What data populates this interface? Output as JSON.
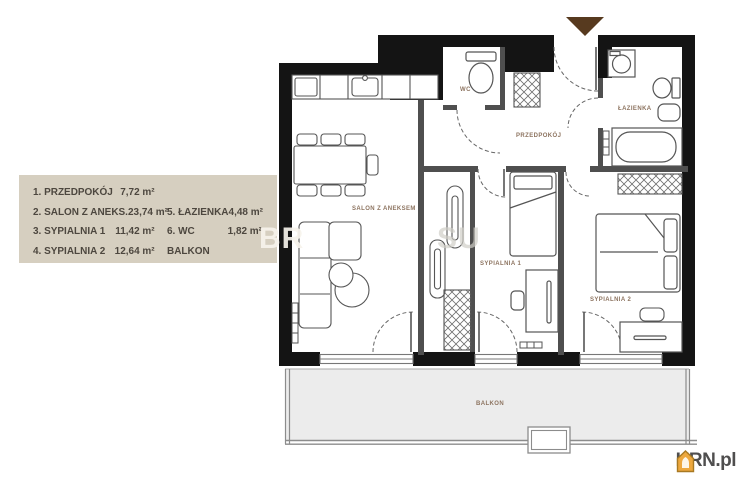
{
  "legend": {
    "background": "#d6cfc0",
    "text_color": "#4d473f",
    "column1": [
      {
        "label": "1. PRZEDPOKÓJ",
        "area": "7,72 m²"
      },
      {
        "label": "2. SALON Z ANEKS.",
        "area": "23,74 m²"
      },
      {
        "label": "3. SYPIALNIA 1",
        "area": "11,42 m²"
      },
      {
        "label": "4. SYPIALNIA 2",
        "area": "12,64 m²"
      }
    ],
    "column2": [
      {
        "label": "5. ŁAZIENKA",
        "area": "4,48 m²"
      },
      {
        "label": "6. WC",
        "area": "1,82 m²"
      },
      {
        "label": "BALKON",
        "area": ""
      }
    ]
  },
  "floorplan": {
    "room_labels": {
      "salon": "SALON Z ANEKSEM",
      "wc": "WC",
      "przedpokoj": "PRZEDPOKÓJ",
      "lazienka": "ŁAZIENKA",
      "sypialnia1": "SYPIALNIA 1",
      "sypialnia2": "SYPIALNIA 2",
      "balkon": "BALKON"
    },
    "label_color": "#8d7460",
    "entrance_marker_color": "#573a1f",
    "wall_color": "#141414",
    "balcony_fill": "#ececec"
  },
  "watermark": {
    "part1": "BR",
    "part2": "SU"
  },
  "branding": {
    "logo_text": "KRN.pl",
    "icon": "house-icon",
    "icon_color": "#eda83e"
  }
}
